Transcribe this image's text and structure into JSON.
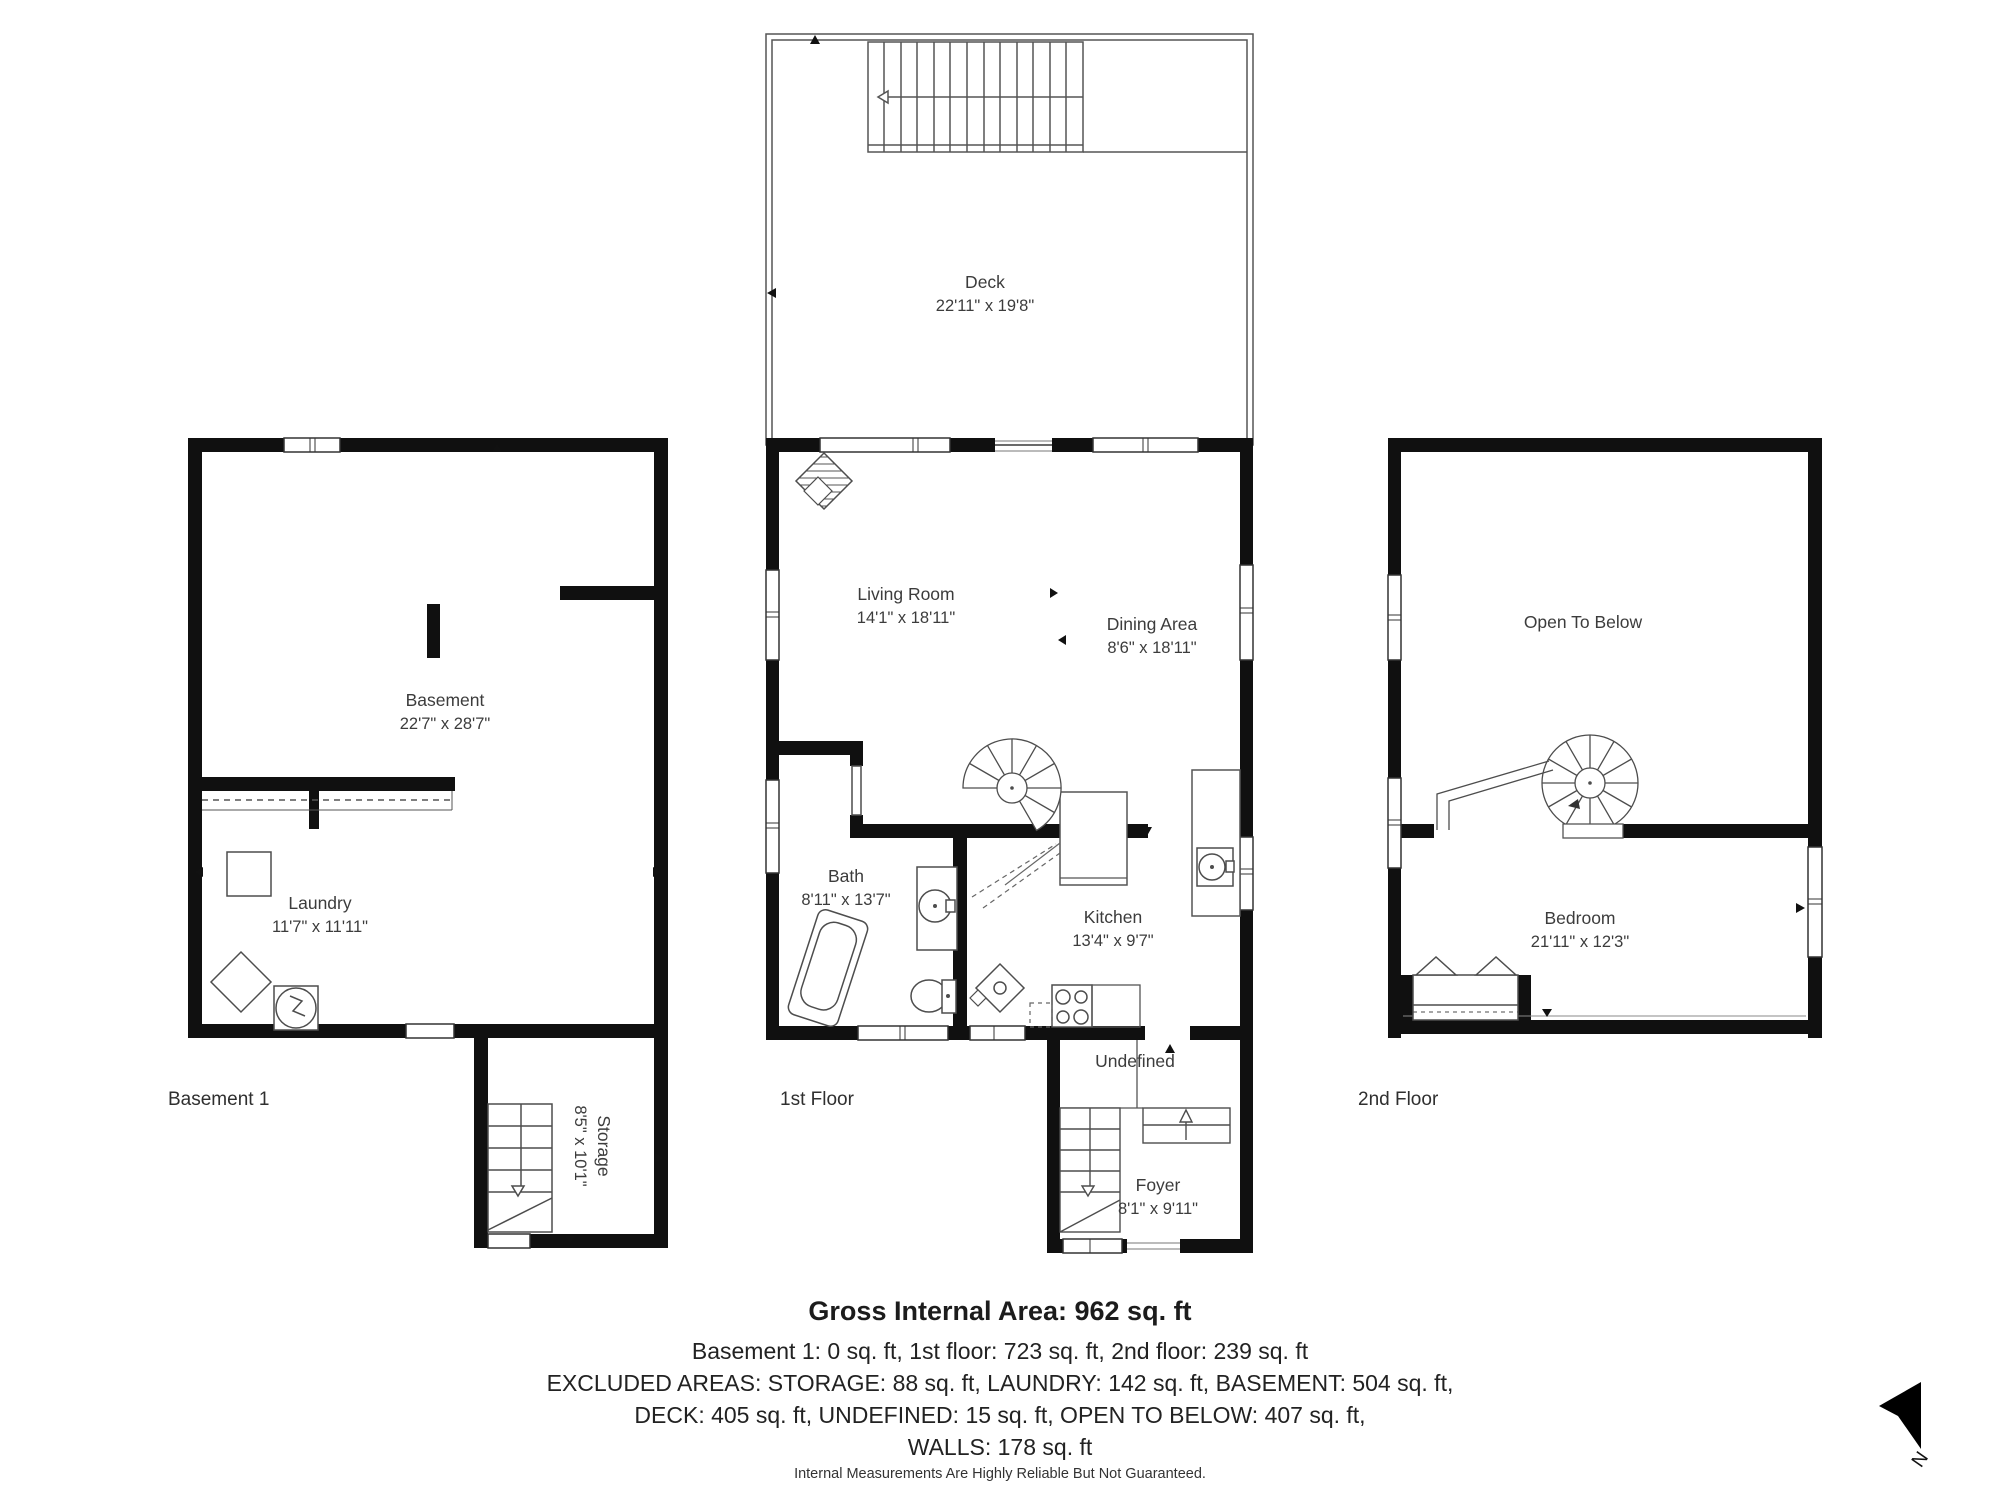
{
  "floors": {
    "basement": {
      "floor_label": "Basement 1",
      "rooms": {
        "basement": {
          "name": "Basement",
          "dims": "22'7\" x 28'7\""
        },
        "laundry": {
          "name": "Laundry",
          "dims": "11'7\" x 11'11\""
        },
        "storage": {
          "name": "Storage",
          "dims": "8'5\" x 10'1\""
        }
      }
    },
    "first": {
      "floor_label": "1st Floor",
      "rooms": {
        "deck": {
          "name": "Deck",
          "dims": "22'11\" x 19'8\""
        },
        "living": {
          "name": "Living Room",
          "dims": "14'1\" x 18'11\""
        },
        "dining": {
          "name": "Dining Area",
          "dims": "8'6\" x 18'11\""
        },
        "bath": {
          "name": "Bath",
          "dims": "8'11\" x 13'7\""
        },
        "kitchen": {
          "name": "Kitchen",
          "dims": "13'4\" x 9'7\""
        },
        "undefined_room": {
          "name": "Undefined"
        },
        "foyer": {
          "name": "Foyer",
          "dims": "8'1\" x 9'11\""
        }
      }
    },
    "second": {
      "floor_label": "2nd Floor",
      "rooms": {
        "open_to_below": {
          "name": "Open To Below"
        },
        "bedroom": {
          "name": "Bedroom",
          "dims": "21'11\" x 12'3\""
        }
      }
    }
  },
  "summary": {
    "title": "Gross Internal Area: 962 sq. ft",
    "line1": "Basement 1: 0 sq. ft, 1st floor: 723 sq. ft, 2nd floor: 239 sq. ft",
    "line2": "EXCLUDED AREAS: STORAGE: 88 sq. ft, LAUNDRY: 142 sq. ft, BASEMENT: 504 sq. ft,",
    "line3": "DECK: 405 sq. ft, UNDEFINED: 15 sq. ft, OPEN TO BELOW: 407 sq. ft,",
    "line4": "WALLS: 178 sq. ft",
    "disclaimer": "Internal Measurements Are Highly Reliable But Not Guaranteed."
  },
  "compass": {
    "label": "N"
  },
  "colors": {
    "wall": "#101010",
    "fixture_line": "#4d4d4d",
    "window_line": "#333333",
    "text": "#3c3c3c"
  }
}
